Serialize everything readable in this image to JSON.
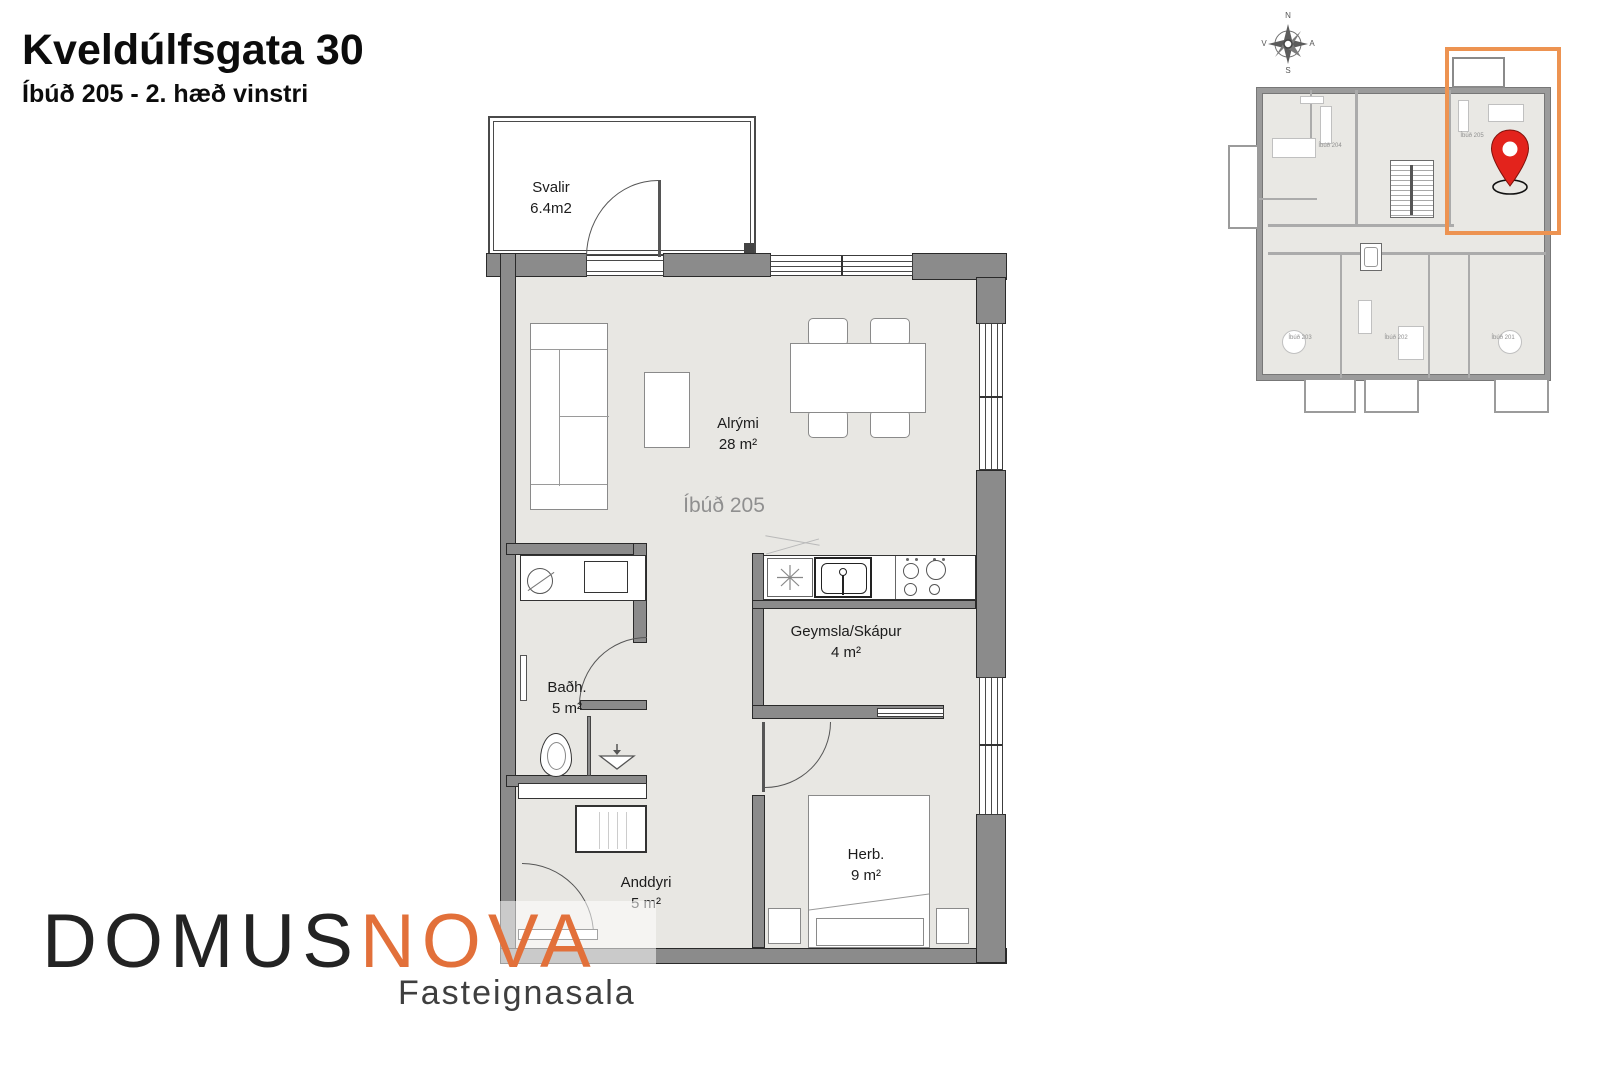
{
  "header": {
    "title": "Kveldúlfsgata 30",
    "subtitle": "Íbúð 205 - 2. hæð vinstri"
  },
  "floorplan": {
    "apartment_label": "Íbúð 205",
    "rooms": {
      "svalir": {
        "name": "Svalir",
        "area": "6.4m2"
      },
      "alrymi": {
        "name": "Alrými",
        "area": "28 m²"
      },
      "badherbergi": {
        "name": "Baðh.",
        "area": "5 m²"
      },
      "geymsla": {
        "name": "Geymsla/Skápur",
        "area": "4 m²"
      },
      "anddyri": {
        "name": "Anddyri",
        "area": "5 m²"
      },
      "herbergi": {
        "name": "Herb.",
        "area": "9 m²"
      }
    }
  },
  "minimap": {
    "compass": {
      "north": "N",
      "south": "S",
      "west": "V",
      "east": "A"
    },
    "apartments": {
      "a204": "Íbúð 204",
      "a205": "Íbúð 205",
      "a203": "Íbúð 203",
      "a202": "Íbúð 202",
      "a201": "Íbúð 201"
    },
    "highlight_color": "#ED9351",
    "pin_color": "#E3231C"
  },
  "logo": {
    "word_primary": "DOMUS",
    "word_accent": "NOVA",
    "tagline": "Fasteignasala",
    "accent_color": "#E2703A"
  },
  "colors": {
    "wall": "#8B8B8B",
    "floor": "#E8E7E3",
    "outline": "#2A2A2A"
  }
}
